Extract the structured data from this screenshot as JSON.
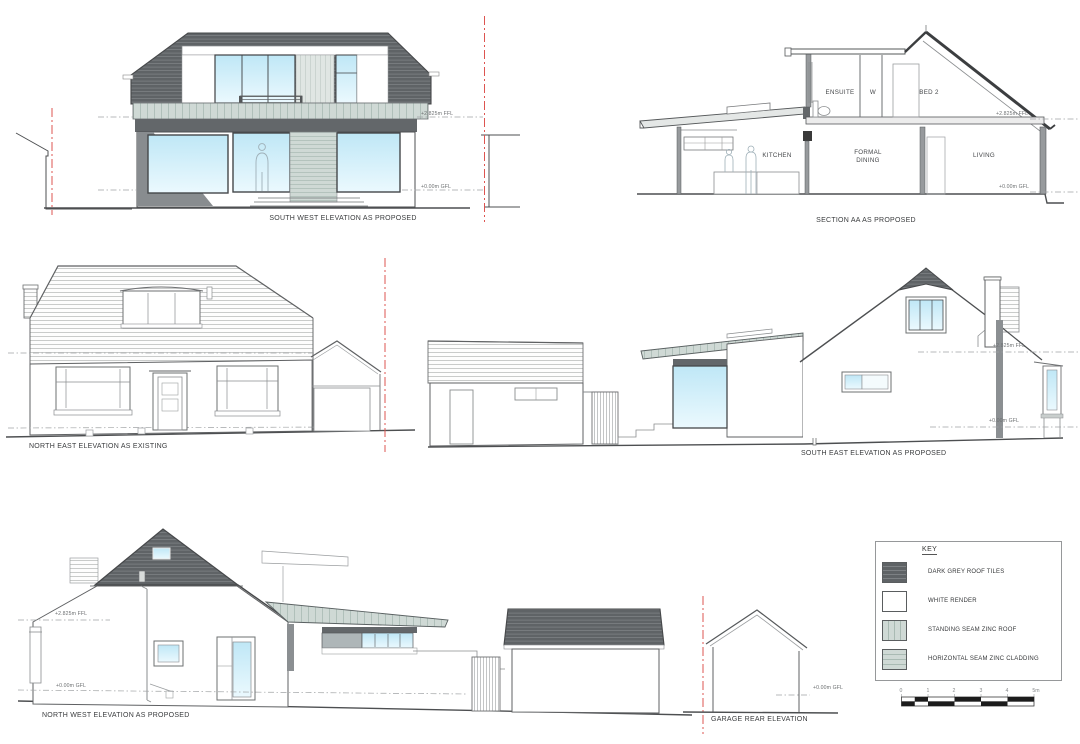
{
  "colors": {
    "dark_roof": "#5f6366",
    "roof_line": "#7d8184",
    "zinc": "#cfd9d5",
    "zinc_seam": "#a9bab3",
    "window_blue": "#bfe7f6",
    "window_blue_light": "#ebf9fe",
    "render_white": "#ffffff",
    "outline": "#4d4f51",
    "boundary_red": "#dd5450"
  },
  "drawings": {
    "south_west": {
      "title": "SOUTH WEST ELEVATION AS PROPOSED",
      "ffl": "+2.825m FFL",
      "gfl": "+0.00m GFL"
    },
    "section_aa": {
      "title": "SECTION AA AS PROPOSED",
      "ffl": "+2.825m FFL",
      "gfl": "+0.00m GFL",
      "rooms": {
        "ensuite": "ENSUITE",
        "wardrobe": "W",
        "bed2": "BED 2",
        "kitchen": "KITCHEN",
        "formal_dining_line1": "FORMAL",
        "formal_dining_line2": "DINING",
        "living": "LIVING"
      }
    },
    "north_east": {
      "title": "NORTH EAST ELEVATION AS EXISTING"
    },
    "south_east": {
      "title": "SOUTH EAST ELEVATION AS PROPOSED",
      "ffl": "+2.825m FFL",
      "gfl": "+0.00m GFL"
    },
    "north_west": {
      "title": "NORTH WEST ELEVATION AS PROPOSED",
      "ffl": "+2.825m FFL",
      "gfl": "+0.00m GFL"
    },
    "garage_rear": {
      "title": "GARAGE REAR ELEVATION",
      "gfl": "+0.00m GFL"
    }
  },
  "key": {
    "title": "KEY",
    "items": [
      {
        "label": "DARK GREY ROOF TILES",
        "swatch": "dark-grey-roof-tiles"
      },
      {
        "label": "WHITE RENDER",
        "swatch": "white-render"
      },
      {
        "label": "STANDING SEAM ZINC ROOF",
        "swatch": "standing-seam-zinc-roof"
      },
      {
        "label": "HORIZONTAL SEAM ZINC CLADDING",
        "swatch": "horizontal-seam-zinc-cladding"
      }
    ]
  },
  "scale_bar": {
    "ticks": [
      "0",
      "1",
      "2",
      "3",
      "4",
      "5m"
    ]
  }
}
